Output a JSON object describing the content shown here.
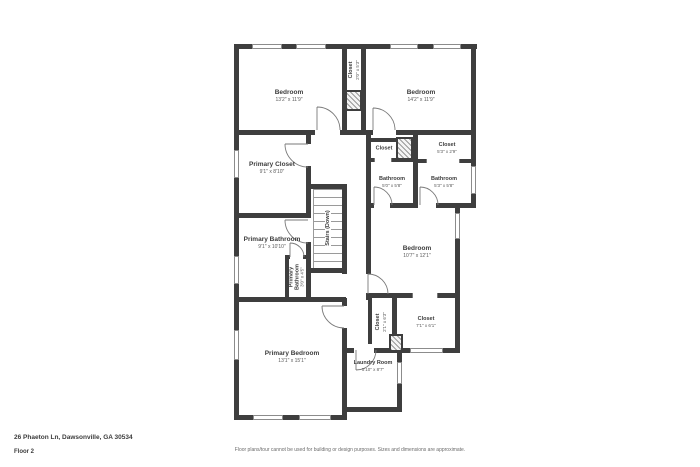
{
  "page": {
    "address": "26 Phaeton Ln, Dawsonville, GA 30534",
    "floor_label": "Floor 2",
    "disclaimer": "Floor plans/tour cannot be used for building or design purposes. Sizes and dimensions are approximate."
  },
  "colors": {
    "wall": "#3e3e3e",
    "floor": "#ffffff",
    "text": "#3c3c3c",
    "window_outline": "#8c8c8c"
  },
  "rooms": {
    "bedroom_top_left": {
      "name": "Bedroom",
      "dims": "13'2\" x 11'9\""
    },
    "bedroom_top_right": {
      "name": "Bedroom",
      "dims": "14'2\" x 11'9\""
    },
    "closet_top": {
      "name": "Closet",
      "dims": "2'0\" x 5'3\""
    },
    "primary_closet": {
      "name": "Primary Closet",
      "dims": "9'1\" x 8'10\""
    },
    "stairs": {
      "name": "Stairs (Down)"
    },
    "closet_small": {
      "name": "Closet",
      "dims": ""
    },
    "closet_hall": {
      "name": "Closet",
      "dims": "5'3\" x 2'9\""
    },
    "bathroom_left": {
      "name": "Bathroom",
      "dims": "5'0\" x 5'8\""
    },
    "bathroom_right": {
      "name": "Bathroom",
      "dims": "5'3\" x 5'8\""
    },
    "bedroom_right": {
      "name": "Bedroom",
      "dims": "10'7\" x 12'1\""
    },
    "primary_bathroom": {
      "name": "Primary Bathroom",
      "dims": "9'1\" x 10'10\""
    },
    "primary_bathroom_wc": {
      "name": "Primary Bathroom",
      "dims": "3'0\" x 4'5\""
    },
    "closet_bottom": {
      "name": "Closet",
      "dims": "7'1\" x 6'1\""
    },
    "closet_narrow": {
      "name": "Closet",
      "dims": "2'1\" x 6'3\""
    },
    "primary_bedroom": {
      "name": "Primary Bedroom",
      "dims": "13'1\" x 15'1\""
    },
    "laundry": {
      "name": "Laundry Room",
      "dims": "5'10\" x 8'7\""
    }
  }
}
